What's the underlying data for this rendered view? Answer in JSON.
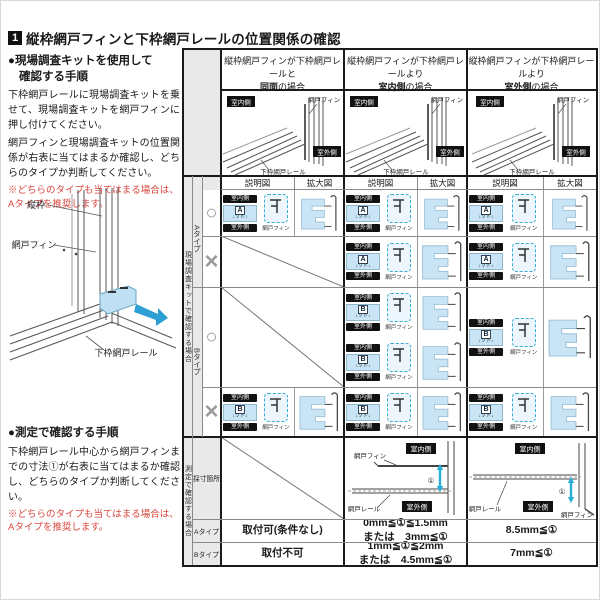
{
  "page": {
    "section_no": "1",
    "title": "縦枠網戸フィンと下枠網戸レールの位置関係の確認"
  },
  "left": {
    "kit": {
      "h1": "●現場調査キットを使用して",
      "h2": "確認する手順",
      "para1": "下枠網戸レールに現場調査キットを乗せて、現場調査キットを網戸フィンに押し付けてください。",
      "para2": "網戸フィンと現場調査キットの位置関係が右表に当てはまるか確認し、どちらのタイプか判断してください。",
      "note": "※どちらのタイプも当てはまる場合は、Aタイプを推奨します。"
    },
    "window_labels": {
      "tatewaku": "縦枠",
      "fin": "網戸フィン",
      "rail": "下枠網戸レール"
    },
    "measure": {
      "heading": "●測定で確認する手順",
      "para": "下枠網戸レール中心から網戸フィンまでの寸法①が右表に当てはまるか確認し、どちらのタイプか判断してください。",
      "note": "※どちらのタイプも当てはまる場合は、Aタイプを推奨します。"
    }
  },
  "table": {
    "col_headers": [
      {
        "pre": "縦枠網戸フィンが下枠網戸レールと",
        "em": "同面",
        "post": "の場合"
      },
      {
        "pre": "縦枠網戸フィンが下枠網戸レールより",
        "em": "室内側",
        "post": "の場合"
      },
      {
        "pre": "縦枠網戸フィンが下枠網戸レールより",
        "em": "室外側",
        "post": "の場合"
      }
    ],
    "overview_labels": {
      "indoor": "室内側",
      "outdoor": "室外側",
      "fin": "網戸フィン",
      "rail": "下枠網戸レール"
    },
    "sub_headers": [
      "説明図",
      "拡大図"
    ],
    "kit_group_label": "現場調査キットで確認する場合",
    "measure_group_label": "測定で確認する場合",
    "type_labels": [
      "Aタイプ",
      "Bタイプ"
    ],
    "kit_text": "↓ソト↓",
    "fin_label": "網戸フィン",
    "rows": [
      {
        "type": "Aタイプ",
        "mark": "○",
        "cells": [
          {
            "kind": "diagram",
            "letter": "A"
          },
          {
            "kind": "diagram",
            "letter": "A"
          },
          {
            "kind": "diagram",
            "letter": "A"
          }
        ]
      },
      {
        "type": "Aタイプ",
        "mark": "×",
        "cells": [
          {
            "kind": "na"
          },
          {
            "kind": "diagram",
            "letter": "A"
          },
          {
            "kind": "diagram",
            "letter": "A"
          }
        ]
      },
      {
        "type": "Bタイプ",
        "mark": "○",
        "cells": [
          {
            "kind": "na"
          },
          {
            "kind": "diagram2",
            "letter": "B"
          },
          {
            "kind": "diagram",
            "letter": "B"
          }
        ]
      },
      {
        "type": "Bタイプ",
        "mark": "×",
        "cells": [
          {
            "kind": "diagram",
            "letter": "B"
          },
          {
            "kind": "diagram",
            "letter": "B"
          },
          {
            "kind": "diagram",
            "letter": "B"
          }
        ]
      }
    ],
    "measure": {
      "row_label": "採寸箇所",
      "labels": {
        "fin": "網戸フィン",
        "rail": "網戸レール",
        "indoor": "室内側",
        "outdoor": "室外側",
        "dim": "①"
      },
      "type_rows": [
        {
          "label": "Aタイプ",
          "cells": [
            [
              "取付可(条件なし)"
            ],
            [
              "0mm≦①≦1.5mm",
              "または　3mm≦①"
            ],
            [
              "8.5mm≦①"
            ]
          ]
        },
        {
          "label": "Bタイプ",
          "cells": [
            [
              "取付不可"
            ],
            [
              "1mm≦①≦2mm",
              "または　4.5mm≦①"
            ],
            [
              "7mm≦①"
            ]
          ]
        }
      ]
    }
  },
  "colors": {
    "kit_blue": "#c9e5f5",
    "arrow_cyan": "#29aed6",
    "note_red": "#d9463e",
    "label_black": "#111111",
    "grid_gray": "#8a8a8a",
    "panel_gray": "#e9e9e9"
  }
}
